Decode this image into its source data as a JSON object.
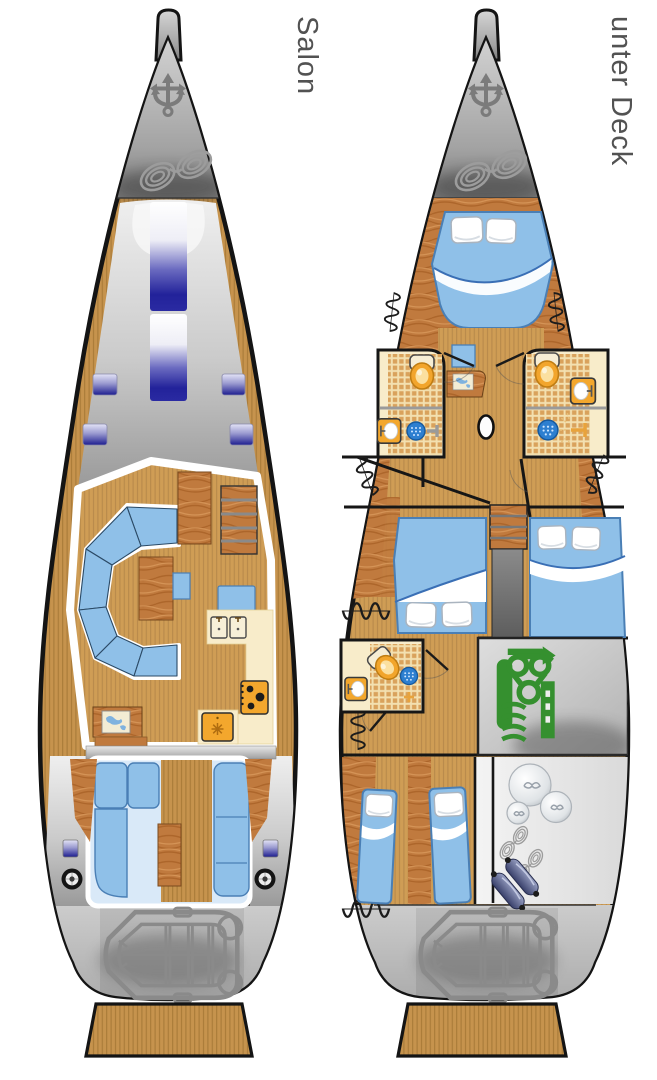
{
  "window": {
    "background": "#ffffff"
  },
  "decks": [
    {
      "id": "salon",
      "label": "Salon",
      "features": [
        "anchor-icon",
        "mooring-rope-coil-icon",
        "bow-sprit",
        "skylight-strip-hatches",
        "deck-hatches",
        "u-shaped-settee",
        "salon-table",
        "sideboard",
        "companionway-stairs",
        "nav-seat",
        "galley-double-sink-icon",
        "stove-icon",
        "fridge-icon",
        "chart-table-with-map",
        "cockpit-benches",
        "cockpit-table",
        "winch-icons",
        "aft-deck-dinghy-icon",
        "swim-platform"
      ]
    },
    {
      "id": "unter-deck",
      "label": "unter Deck",
      "features": [
        "anchor-icon",
        "mooring-rope-coil-icon",
        "v-berth-double-bed",
        "pillow-icons",
        "wardrobe-spring-icons",
        "port-head-toilet-icon",
        "port-head-sink-icon",
        "port-head-shower-drain-icon",
        "starboard-head-toilet-icon",
        "starboard-head-sink-icon",
        "starboard-head-shower-icon",
        "nav-desk-with-map",
        "nav-stool",
        "mast-base",
        "port-double-cabin-bed",
        "starboard-double-cabin-bed",
        "companionway-stairs",
        "aft-head-toilet-icon",
        "aft-head-sink-icon",
        "engine-icon",
        "twin-berths-aft-cabin",
        "fender-ball-icons",
        "rope-coil-icons",
        "fender-icons",
        "aft-deck-dinghy-icon",
        "swim-platform"
      ]
    }
  ],
  "colors": {
    "teak_deck": "#c6934d",
    "wood_furniture": "#c07a3e",
    "cabin_floor": "#cf9d55",
    "upholstery_blue": "#8fc0e8",
    "hatch_navy": "#23239a",
    "galley_cream": "#f8ecca",
    "appliance_orange": "#f3a72d",
    "engine_green": "#35902f",
    "fender_blue": "#515c88",
    "hull_gray": "#9b9b9b",
    "outline_black": "#141414",
    "label_gray": "#525252"
  }
}
